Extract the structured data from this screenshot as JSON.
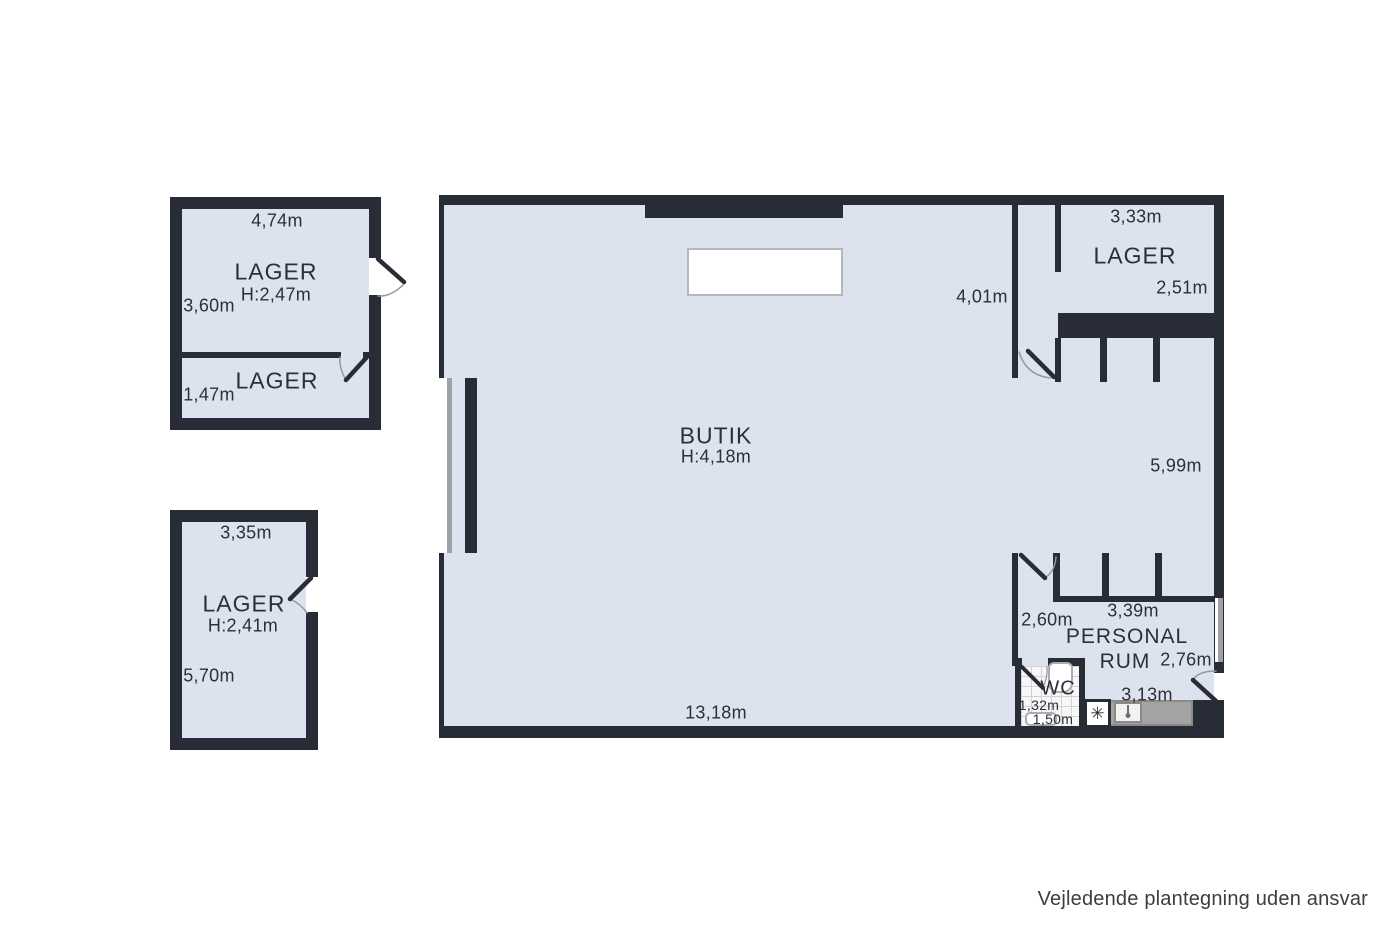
{
  "title": "Floor plan",
  "footer": {
    "disclaimer": "Vejledende plantegning uden ansvar"
  },
  "colors": {
    "wall": "#282c36",
    "floor": "#dde3ee",
    "window_gray": "#9da0a5",
    "counter_gray": "#a3a3a2",
    "text": "#2b2f39"
  },
  "icons": {
    "freezer": "✳"
  },
  "annex_top": {
    "lager_main": {
      "label": "LAGER",
      "ceiling_height": "H:2,47m",
      "dim_top": "4,74m",
      "dim_left": "3,60m"
    },
    "lager_small": {
      "label": "LAGER",
      "dim_left": "1,47m"
    }
  },
  "annex_bottom": {
    "lager": {
      "label": "LAGER",
      "ceiling_height": "H:2,41m",
      "dim_top": "3,35m",
      "dim_left": "5,70m"
    }
  },
  "main_building": {
    "butik": {
      "label": "BUTIK",
      "ceiling_height": "H:4,18m",
      "dim_bottom": "13,18m",
      "dim_corridor": "4,01m",
      "dim_right": "5,99m"
    },
    "lager_ne": {
      "label": "LAGER",
      "dim_top": "3,33m",
      "dim_right": "2,51m"
    },
    "personal_rum": {
      "label_line1": "PERSONAL",
      "label_line2": "RUM",
      "dim_left": "2,60m",
      "dim_top": "3,39m",
      "dim_right": "2,76m",
      "dim_bottom": "3,13m"
    },
    "wc": {
      "label": "WC",
      "dim_width": "1,32m",
      "dim_depth": "1,50m"
    }
  }
}
